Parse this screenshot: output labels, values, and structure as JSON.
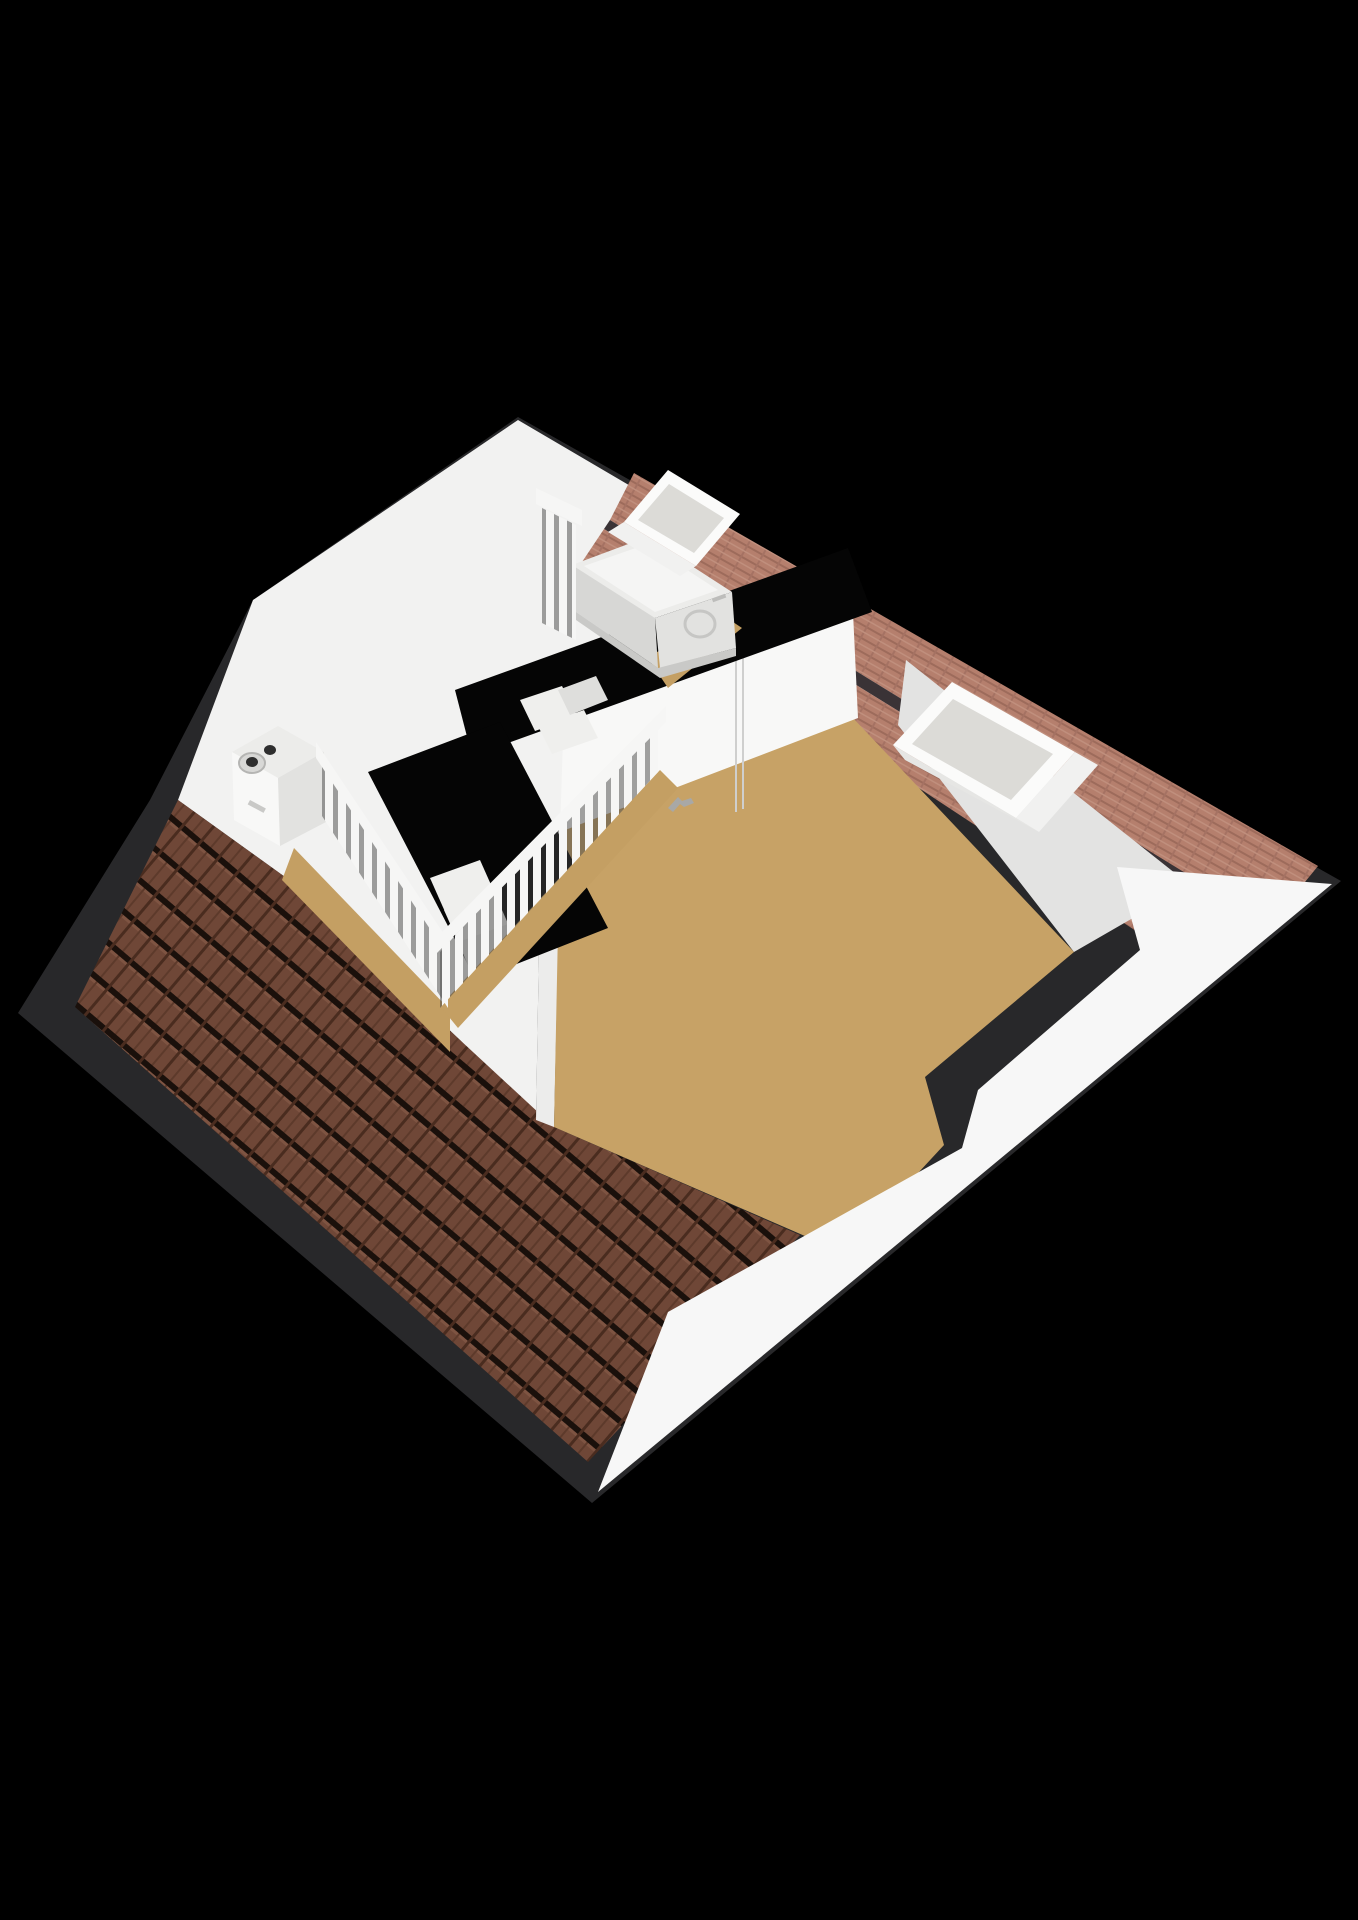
{
  "viewer": {
    "type": "3d-floorplan-render",
    "floor_shown": "attic",
    "rooms_visible": 2,
    "background": "#000000"
  },
  "scene": {
    "objects": [
      "tiled-rear-roof-slope",
      "ridge-tile-band",
      "white-front-roof-slope",
      "gable-walls",
      "dividing-wall-with-door",
      "door-handle",
      "l-shaped-stairwell",
      "stair-steps",
      "balustrade-railings",
      "washer-dryer",
      "boiler-unit",
      "skylight-left-room",
      "skylight-right-room",
      "tan-floor-left-room",
      "tan-floor-right-room"
    ],
    "skylight_count": 2,
    "railing_runs": 3
  },
  "palette": {
    "background": "#000000",
    "fascia_dark": "#28282a",
    "wall_cut_dark": "#3b3b3d",
    "stairwell_black": "#050505",
    "white_base": "#f2f2f1",
    "white_slope": "#f7f7f7",
    "wall_face": "#f8f8f7",
    "gray_wall": "#e3e3e2",
    "white_strip": "#ececeb",
    "floor_tan": "#c7a266",
    "floor_tan_left": "#c49f63",
    "tile_brown": "#6f4737",
    "tile_gap": "#1a100b",
    "tile_col": "#4a2c1f",
    "ridge_pink": "#b57f6d",
    "ridge_pink_line": "#9d6b5b",
    "ridge_dark_line": "#3a3336",
    "rail_white": "#f6f6f5",
    "rail_gap": "rgba(70,70,70,0.5)",
    "washer_top": "#ececea",
    "washer_front": "#e2e2e0",
    "washer_side": "#d7d7d5",
    "glass_gray": "#dcdbd7",
    "frame_white": "#fbfbfa",
    "sill_white": "#f1f1f0",
    "handle_gray": "#a8a8a6",
    "seam_gray": "#cfcfce",
    "step_white": "#efefed",
    "boiler_hole": "#2e2e2e",
    "label_gray": "#c9c9c7"
  }
}
